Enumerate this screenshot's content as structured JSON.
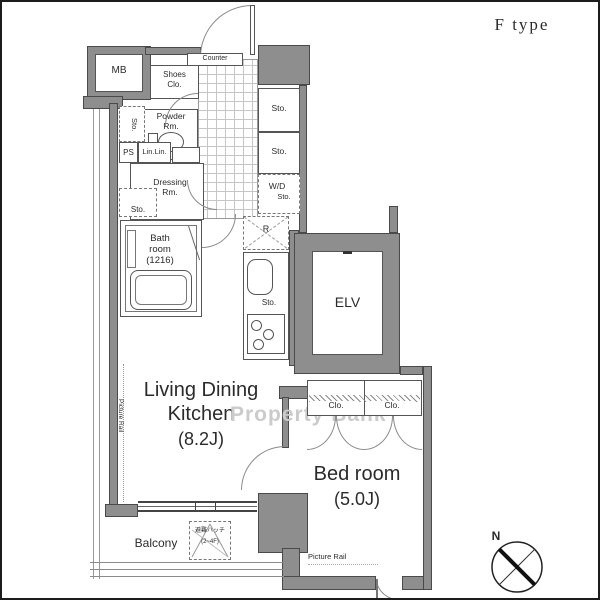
{
  "title": "F type",
  "watermark": "Property Bank",
  "compass": {
    "label": "N"
  },
  "rooms": {
    "mb": "MB",
    "shoes_clo_1": "Shoes",
    "shoes_clo_2": "Clo.",
    "counter": "Counter",
    "powder_1": "Powder",
    "powder_2": "Rm.",
    "sto_vertical": "Sto.",
    "ps": "PS",
    "lin_lin": "Lin.Lin.",
    "lin": "Lin.",
    "dressing_1": "Dressing",
    "dressing_2": "Rm.",
    "sto_small": "Sto.",
    "bath_1": "Bath",
    "bath_2": "room",
    "bath_3": "(1216)",
    "sto_a": "Sto.",
    "sto_b": "Sto.",
    "wd": "W/D",
    "wd_sto": "Sto.",
    "fridge": "R",
    "kitchen_sto": "Sto.",
    "elevator": "ELV",
    "ldk_1": "Living Dining",
    "ldk_2": "Kitchen",
    "ldk_3": "(8.2J)",
    "picture_rail_left": "Picture Rail",
    "clo_left": "Clo.",
    "clo_right": "Clo.",
    "bedroom_1": "Bed room",
    "bedroom_2": "(5.0J)",
    "picture_rail_bottom": "Picture Rail",
    "balcony": "Balcony",
    "hatch_1": "避難ハッチ",
    "hatch_2": "(2~4F)"
  },
  "colors": {
    "wall_gray": "#8e8e8e",
    "line": "#555555",
    "watermark_gray": "#cbcbcb",
    "text": "#2b2b2b"
  }
}
